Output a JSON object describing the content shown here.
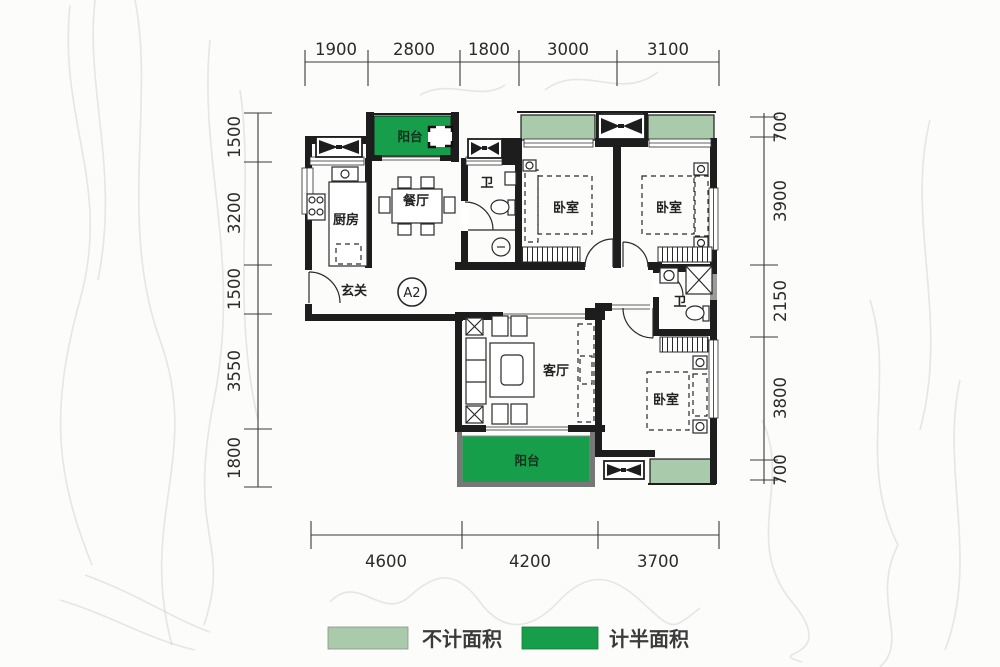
{
  "plan": {
    "unit_label": "A2"
  },
  "dimensions": {
    "top": [
      "1900",
      "2800",
      "1800",
      "3000",
      "3100"
    ],
    "bottom": [
      "4600",
      "4200",
      "3700"
    ],
    "left": [
      "1500",
      "3200",
      "1500",
      "3550",
      "1800"
    ],
    "right": [
      "700",
      "3900",
      "2150",
      "3800",
      "700"
    ]
  },
  "rooms": {
    "balcony_top": "阳台",
    "balcony_bottom": "阳台",
    "kitchen": "厨房",
    "dining": "餐厅",
    "living": "客厅",
    "entry": "玄关",
    "bath1": "卫",
    "bath2": "卫",
    "bedroom1": "卧室",
    "bedroom2": "卧室",
    "bedroom3": "卧室"
  },
  "legend": [
    {
      "label": "不计面积",
      "color": "#a9caab"
    },
    {
      "label": "计半面积",
      "color": "#179e4a"
    }
  ],
  "colors": {
    "no_count": "#a9caab",
    "half_count": "#179e4a",
    "wall": "#1d1d1d"
  }
}
